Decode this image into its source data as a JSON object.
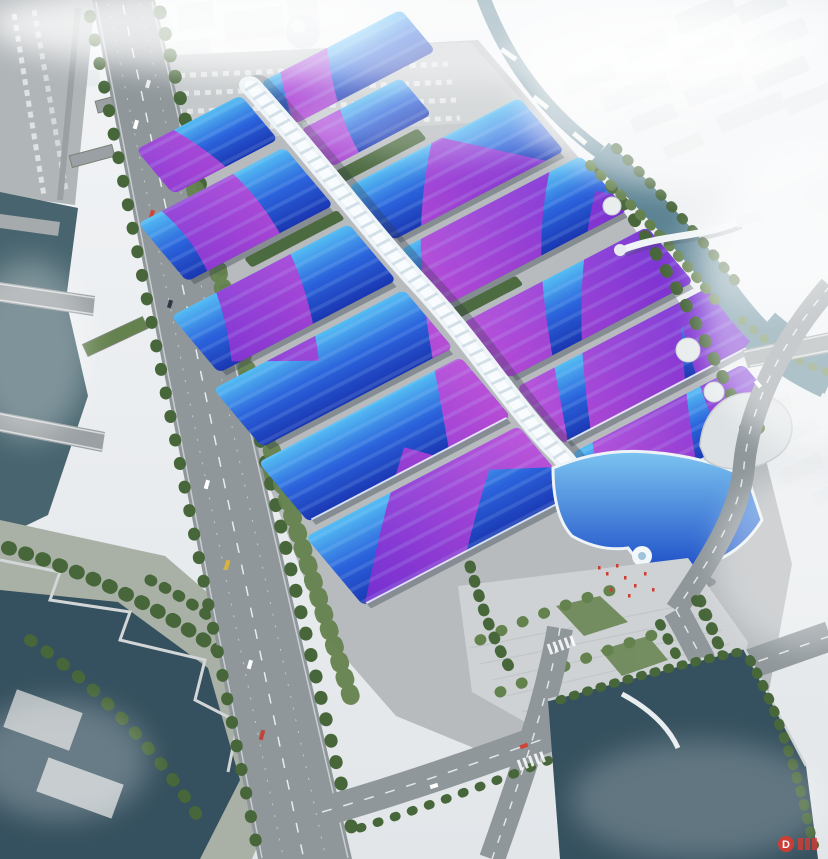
{
  "scene": {
    "type": "architectural aerial rendering",
    "subject": "riverside exhibition and convention center: long white corridor spine flanked by rows of blue wave-roof halls with purple ribbon graphics, surrounded by boulevards, canals and hazy city blocks",
    "watermark": {
      "text": "D"
    }
  },
  "palette": {
    "sky_top": "#f2f4f6",
    "sky_bottom": "#e2e6e9",
    "city": "#e4e8ea",
    "fog": "#ffffff",
    "roof_light": "#55bdf4",
    "roof_mid": "#2b63dc",
    "roof_deep": "#1a36b2",
    "swoosh_purple": "#7e2ed2",
    "swoosh_magenta": "#c94fd8",
    "spine": "#edf3f7",
    "spine_rib": "#c9d8e2",
    "shell_light": "#7cc4f0",
    "shell_deep": "#1e50c8",
    "water_river": "#48656f",
    "water_basin": "#35505e",
    "water_canal": "#5d8494",
    "road": "#8f979b",
    "pad": "#b7bbbe",
    "parking": "#c5c9cb",
    "plaza": "#ced2d4",
    "green_dark": "#47663a",
    "green_mid": "#64824e",
    "flag_red": "#cf3a32",
    "watermark_red": "#d93a30"
  }
}
